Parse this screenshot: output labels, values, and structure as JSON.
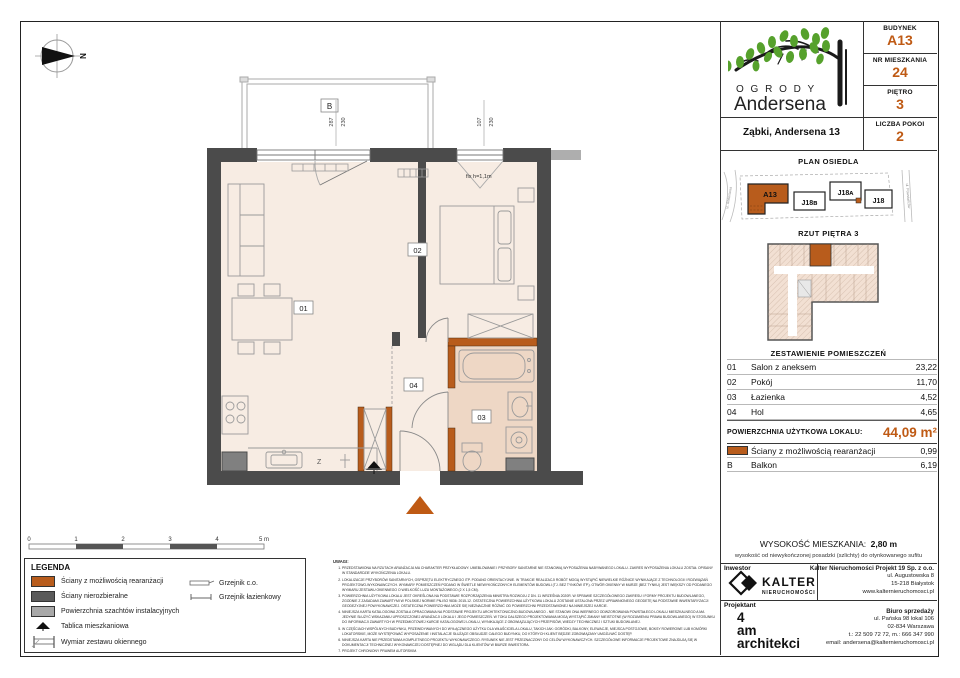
{
  "accent": "#bf5a14",
  "header": {
    "logo_line1": "O G R O D Y",
    "logo_line2": "Andersena",
    "address": "Ząbki, Andersena 13",
    "info": [
      {
        "label": "BUDYNEK",
        "value": "A13"
      },
      {
        "label": "NR MIESZKANIA",
        "value": "24"
      },
      {
        "label": "PIĘTRO",
        "value": "3"
      },
      {
        "label": "LICZBA POKOI",
        "value": "2"
      }
    ]
  },
  "estate": {
    "title": "PLAN OSIEDLA",
    "buildings": [
      "A13",
      "J18ʙ",
      "J18ᴀ",
      "J18"
    ],
    "street_left": "ul. Andersena",
    "street_right": "ul. Powstańców"
  },
  "overview": {
    "title": "RZUT PIĘTRA 3"
  },
  "rooms": {
    "title": "ZESTAWIENIE POMIESZCZEŃ",
    "rows": [
      {
        "no": "01",
        "name": "Salon z aneksem",
        "area": "23,22"
      },
      {
        "no": "02",
        "name": "Pokój",
        "area": "11,70"
      },
      {
        "no": "03",
        "name": "Łazienka",
        "area": "4,52"
      },
      {
        "no": "04",
        "name": "Hol",
        "area": "4,65"
      }
    ],
    "total_label": "POWIERZCHNIA UŻYTKOWA LOKALU:",
    "total_value": "44,09 m²",
    "extra": [
      {
        "no": "",
        "name": "Ściany z możliwością rearanżacji",
        "area": "0,99"
      },
      {
        "no": "B",
        "name": "Balkon",
        "area": "6,19"
      }
    ]
  },
  "height": {
    "label": "WYSOKOŚĆ MIESZKANIA:",
    "value": "2,80 m",
    "note": "wysokość od niewykończonej posadzki (szlichty) do otynkowanego sufitu"
  },
  "footer": {
    "investor_label": "Inwestor",
    "designer_label": "Projektant",
    "brand": {
      "name": "KALTER",
      "sub": "NIERUCHOMOŚCI"
    },
    "company": {
      "name": "Kalter Nieruchomości Projekt 19 Sp. z o.o.",
      "lines": [
        "ul. Augustowska 8",
        "15-218 Białystok",
        "www.kalternieruchomosci.pl"
      ]
    },
    "designer": {
      "l1": "4",
      "l2": "am",
      "l3": "architekci"
    },
    "sales": {
      "title": "Biuro sprzedaży",
      "lines": [
        "ul. Pańska 98 lokal 106",
        "02-834 Warszawa",
        "t.: 22 509 72 72, m.: 666 347 990",
        "email: andersena@kalternieruchomosci.pl"
      ]
    }
  },
  "legend": {
    "title": "LEGENDA",
    "items": [
      "Ściany z możliwością rearanżacji",
      "Ściany nierozbieralne",
      "Powierzchnia szachtów instalacyjnych",
      "Tablica mieszkaniowa",
      "Wymiar zestawu okiennego"
    ],
    "right_items": [
      "Grzejnik c.o.",
      "Grzejnik łazienkowy"
    ]
  },
  "scalebar": {
    "labels": [
      "0",
      "1",
      "2",
      "3",
      "4",
      "5 m"
    ]
  },
  "notes": {
    "title": "UWAGI:",
    "items": [
      "PRZEDSTAWIONA NA RZUTACH ARANŻACJA MA CHARAKTER PRZYKŁADOWY. UMEBLOWANIE I PRZYBORY SANITARNE NIE STANOWIĄ WYPOSAŻENIA NABYWANEGO LOKALU. ZAKRES WYPOSAŻENIA LOKALU ZOSTAŁ OPISANY W STANDARDZIE WYKOŃCZENIA LOKALU.",
      "LOKALIZACJE PRZYBORÓW SANITARNYCH, OSPRZĘTU ELEKTRYCZNEGO ITP. PODANO ORIENTACYJNIE. W TRAKCIE REALIZACJI ROBÓT MOGĄ WYSTĄPIĆ NIEWIELKIE RÓŻNICE WYNIKAJĄCE Z TECHNOLOGII I ROZWIĄZAŃ PROJEKTOWO-WYKONAWCZYCH. WYMIARY POMIESZCZEŃ PODANO W ŚWIETLE NIEWYKOŃCZONYCH ELEMENTÓW BUDOWLI (TJ. BEZ TYNKÓW ITP.). OTWÓR OKIENNY W MURZE (BEZ TYNKU) JEST WIĘKSZY OD PODANEGO WYMIARU ZESTAWU OKIENNEGO O WIELKOŚĆ LUZU MONTAŻOWEGO (2 X 1,5 CM).",
      "POWIERZCHNIA UŻYTKOWA LOKALU JEST OKREŚLONA NA PODSTAWIE ROZPORZĄDZENIA MINISTRA ROZWOJU Z DN. 11 WRZEŚNIA 2020R. W SPRAWIE SZCZEGÓŁOWEGO ZAKRESU I FORMY PROJEKTU BUDOWLANEGO, ZGODNIE Z ZASADAMI ZAWARTYMI W POLSKIEJ NORMIE PN-ISO 9836: 2015-12. OSTATECZNA POWIERZCHNIA UŻYTKOWA LOKALU ZOSTANIE USTALONA PRZEZ UPRAWNIONEGO GEODETĘ NA PODSTAWIE INWENTARYZACJI GEODEZYJNEJ POWYKONAWCZEJ. OSTATECZNA POWIERZCHNIA MOŻE SIĘ NIEZNACZNIE RÓŻNIĆ OD POWIERZCHNI PRZEDSTAWIONEJ NA NINIEJSZEJ KARCIE.",
      "NINIEJSZA KARTA KATALOGOWA ZOSTAŁA OPRACOWANA NA PODSTAWIE PROJEKTU ARCHITEKTONICZNO-BUDOWLANEGO - NIE STANOWI ONA WIERNEGO ODWZOROWANIA POWSTAŁEGO LOKALU MIESZKALNEGO A MA JEDYNIE SŁUŻYĆ WSKAZANIU UPROSZCZONEJ ARANŻACJI LOKALU I JEGO POMIESZCZEŃ. W TOKU DALSZEGO PROJEKTOWANIA MOGĄ WYSTĄPIĆ ZMIANY NIEISTOTNE (W ROZUMIENIU PRAWA BUDOWLANEGO) W STOSUNKU DO INFORMACJI ZAWARTYCH W PRZEDMIOTOWEJ KARCIE KATALOGOWEJ LOKALU, WYNIKAJĄCE Z OBOWIĄZUJĄCYCH PRZEPISÓW, WIEDZY TECHNICZNEJ I SZTUKI BUDOWLANEJ.",
      "W CZĘŚCIACH WSPÓLNYCH BUDYNKU, PRZEWIDYWANYCH DO WYŁĄCZNEGO UŻYTKU DLA WŁAŚCICIELA LOKALU, TAKICH JAK: OGRÓDKI, BALKONY, ELEWACJE, MIEJSCA POSTOJOWE, BOKSY ROWEROWE LUB KOMÓRKI LOKATORSKIE, MOŻE WYSTĘPOWAĆ WYPOSAŻENIE I INSTALACJE SŁUŻĄCE OBSŁUDZE CAŁEGO BUDYNKU, DO KTÓRYCH KLIENT BĘDZIE ZOBOWIĄZANY UMOŻLIWIĆ DOSTĘP.",
      "NINIEJSZA KARTA NIE PRZEDSTAWIA KOMPLETNEGO PROJEKTU WYKONAWCZEGO. RYSUNEK NIE JEST PRZEZNACZONY DO CELÓW WYKONAWCZYCH. SZCZEGÓŁOWE INFORMACJE PROJEKTOWE ZNAJDUJĄ SIĘ W DOKUMENTACJI TECHNICZNEJ WYKONAWCZEJ DOSTĘPNEJ DO WGLĄDU DLA KLIENTÓW W BIURZE INWESTORA.",
      "PROJEKT CHRONIONY PRAWEM AUTORSKIM."
    ]
  },
  "plan": {
    "balcony": "B",
    "r01": "01",
    "r02": "02",
    "r03": "03",
    "r04": "04",
    "dim1a": "287",
    "dim1b": "230",
    "dim2a": "107",
    "dim2b": "230",
    "fix": "fix h=1,1m",
    "z": "Z",
    "north": "N"
  }
}
